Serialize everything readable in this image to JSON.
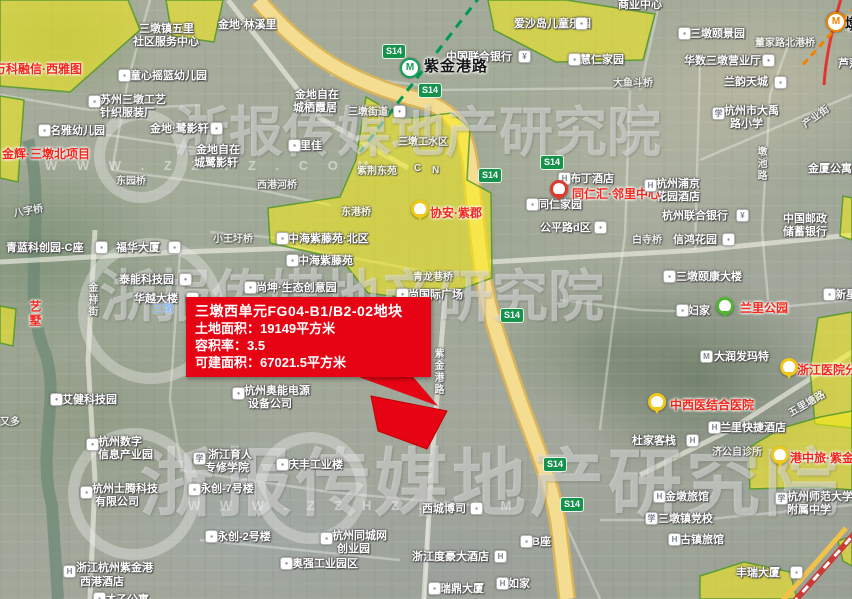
{
  "colors": {
    "accent_red": "#e60313",
    "parcel_fill": "rgba(249,238,20,0.55)",
    "parcel_border": "#55a32b",
    "badge_green": "#15934d",
    "metro_green": "#11a05a",
    "metro_orange": "#f08300",
    "project_red": "#f2261b",
    "water_blue": "#8db4e8"
  },
  "watermark": {
    "brand": "浙报传媒地产研究院",
    "site": "W W W . Z Z H Z . C O M"
  },
  "infobox": {
    "title": "三墩西单元FG04-B1/B2-02地块",
    "land_area": "土地面积：19149平方米",
    "plot_ratio": "容积率：3.5",
    "buildable_area": "可建面积：67021.5平方米"
  },
  "stations": [
    {
      "x": 400,
      "y": 58,
      "c": "#11a05a",
      "g": "M"
    },
    {
      "x": 826,
      "y": 12,
      "c": "#f08300",
      "g": "M"
    }
  ],
  "badges": [
    {
      "x": 382,
      "y": 44,
      "t": "S14"
    },
    {
      "x": 418,
      "y": 83,
      "t": "S14"
    },
    {
      "x": 540,
      "y": 155,
      "t": "S14"
    },
    {
      "x": 478,
      "y": 168,
      "t": "S14"
    },
    {
      "x": 500,
      "y": 308,
      "t": "S14"
    },
    {
      "x": 543,
      "y": 457,
      "t": "S14"
    },
    {
      "x": 560,
      "y": 497,
      "t": "S14"
    }
  ],
  "pins": [
    {
      "x": 550,
      "y": 180,
      "c": "#e0392c"
    },
    {
      "x": 411,
      "y": 200,
      "c": "#eec81b"
    },
    {
      "x": 716,
      "y": 297,
      "c": "#52b335"
    },
    {
      "x": 780,
      "y": 358,
      "c": "#eec81b"
    },
    {
      "x": 648,
      "y": 393,
      "c": "#eec81b"
    },
    {
      "x": 771,
      "y": 446,
      "c": "#eec81b"
    }
  ],
  "red_labels": [
    {
      "t": "万科融信·西雅图",
      "x": -6,
      "y": 60
    },
    {
      "t": "金辉·三墩北项目",
      "x": 2,
      "y": 145
    },
    {
      "t": "同仁汇·邻里中心",
      "x": 572,
      "y": 185
    },
    {
      "t": "协安·紫郡",
      "x": 430,
      "y": 204
    },
    {
      "t": "兰里公园",
      "x": 740,
      "y": 299
    },
    {
      "t": "浙江医院分",
      "x": 797,
      "y": 361
    },
    {
      "t": "中西医结合医院",
      "x": 670,
      "y": 396
    },
    {
      "t": "港中旅·紫金",
      "x": 790,
      "y": 449
    },
    {
      "t": "艺墅",
      "x": 27,
      "y": 300,
      "cls": "v"
    }
  ],
  "poi_labels": [
    {
      "t": "金地·林溪里",
      "x": 218,
      "y": 16
    },
    {
      "t": "三墩镇五里",
      "x": 139,
      "y": 20
    },
    {
      "t": "社区服务中心",
      "x": 133,
      "y": 33
    },
    {
      "t": "童心摇篮幼儿园",
      "x": 130,
      "y": 67
    },
    {
      "t": "苏州三墩工艺",
      "x": 100,
      "y": 91
    },
    {
      "t": "针织服装厂",
      "x": 100,
      "y": 104
    },
    {
      "t": "名雅幼儿园",
      "x": 50,
      "y": 122
    },
    {
      "t": "金地·鹭影轩",
      "x": 150,
      "y": 120
    },
    {
      "t": "金地自在",
      "x": 295,
      "y": 86
    },
    {
      "t": "城栖霞居",
      "x": 293,
      "y": 99
    },
    {
      "t": "里佳",
      "x": 300,
      "y": 137
    },
    {
      "t": "金地自在",
      "x": 196,
      "y": 141
    },
    {
      "t": "城鹭影轩",
      "x": 194,
      "y": 154
    },
    {
      "t": "爱沙岛儿童乐园",
      "x": 514,
      "y": 15
    },
    {
      "t": "中国联合银行",
      "x": 446,
      "y": 48
    },
    {
      "t": "慧仁家园",
      "x": 580,
      "y": 51
    },
    {
      "t": "商业中心",
      "x": 618,
      "y": -4
    },
    {
      "t": "三墩颐景园",
      "x": 690,
      "y": 25
    },
    {
      "t": "董家路北港桥",
      "x": 755,
      "y": 34,
      "cls": "dim"
    },
    {
      "t": "华数三墩营业厅",
      "x": 684,
      "y": 52
    },
    {
      "t": "大鱼斗桥",
      "x": 613,
      "y": 74,
      "cls": "dim"
    },
    {
      "t": "兰韵天城",
      "x": 724,
      "y": 73
    },
    {
      "t": "杭州市大禹",
      "x": 724,
      "y": 102
    },
    {
      "t": "路小学",
      "x": 730,
      "y": 115
    },
    {
      "t": "芦荡",
      "x": 838,
      "y": 55
    },
    {
      "t": "金厦公寓",
      "x": 808,
      "y": 160
    },
    {
      "t": "杭州浦京",
      "x": 656,
      "y": 175
    },
    {
      "t": "花园酒店",
      "x": 656,
      "y": 188
    },
    {
      "t": "布丁酒店",
      "x": 570,
      "y": 170
    },
    {
      "t": "同仁家园",
      "x": 538,
      "y": 196
    },
    {
      "t": "公平路d区",
      "x": 540,
      "y": 219
    },
    {
      "t": "杭州联合银行",
      "x": 662,
      "y": 207
    },
    {
      "t": "白寺桥",
      "x": 632,
      "y": 231,
      "cls": "dim"
    },
    {
      "t": "信鸿花园",
      "x": 673,
      "y": 231
    },
    {
      "t": "中国邮政",
      "x": 783,
      "y": 210
    },
    {
      "t": "储蓄银行",
      "x": 783,
      "y": 223
    },
    {
      "t": "三墩颐康大楼",
      "x": 676,
      "y": 268
    },
    {
      "t": "新星",
      "x": 835,
      "y": 286
    },
    {
      "t": "妇家",
      "x": 688,
      "y": 302
    },
    {
      "t": "大润发玛特",
      "x": 714,
      "y": 348
    },
    {
      "t": "兰里快捷酒店",
      "x": 720,
      "y": 419
    },
    {
      "t": "杜家客栈",
      "x": 632,
      "y": 432
    },
    {
      "t": "济公自诊所",
      "x": 712,
      "y": 443,
      "cls": "dim"
    },
    {
      "t": "杭州师范大学",
      "x": 787,
      "y": 488
    },
    {
      "t": "附属中学",
      "x": 787,
      "y": 501
    },
    {
      "t": "金墩旅馆",
      "x": 665,
      "y": 488
    },
    {
      "t": "三墩镇党校",
      "x": 658,
      "y": 510
    },
    {
      "t": "古镇旅馆",
      "x": 680,
      "y": 531
    },
    {
      "t": "丰瑞大厦",
      "x": 736,
      "y": 564
    },
    {
      "t": "B座",
      "x": 532,
      "y": 533
    },
    {
      "t": "如家",
      "x": 508,
      "y": 575
    },
    {
      "t": "瑞鼎大厦",
      "x": 440,
      "y": 580
    },
    {
      "t": "浙江度豪大酒店",
      "x": 412,
      "y": 548
    },
    {
      "t": "西城博司",
      "x": 422,
      "y": 500
    },
    {
      "t": "杭州同城网",
      "x": 332,
      "y": 527
    },
    {
      "t": "创业园",
      "x": 337,
      "y": 540
    },
    {
      "t": "奥强工业园区",
      "x": 292,
      "y": 555
    },
    {
      "t": "永创-2号楼",
      "x": 217,
      "y": 528
    },
    {
      "t": "永创-7号楼",
      "x": 200,
      "y": 480
    },
    {
      "t": "庆丰工业楼",
      "x": 288,
      "y": 456
    },
    {
      "t": "浙江育人",
      "x": 208,
      "y": 446
    },
    {
      "t": "专修学院",
      "x": 205,
      "y": 459
    },
    {
      "t": "杭州奥能电源",
      "x": 244,
      "y": 382
    },
    {
      "t": "设备公司",
      "x": 248,
      "y": 395
    },
    {
      "t": "艾健科技园",
      "x": 62,
      "y": 391
    },
    {
      "t": "杭州数字",
      "x": 98,
      "y": 433
    },
    {
      "t": "信息产业园",
      "x": 98,
      "y": 446
    },
    {
      "t": "杭州士腾科技",
      "x": 92,
      "y": 480
    },
    {
      "t": "有限公司",
      "x": 95,
      "y": 493
    },
    {
      "t": "又多",
      "x": 0,
      "y": 413,
      "cls": "dim"
    },
    {
      "t": "浙江杭州紫金港",
      "x": 76,
      "y": 559
    },
    {
      "t": "西港酒店",
      "x": 80,
      "y": 573
    },
    {
      "t": "才子公寓",
      "x": 105,
      "y": 591
    },
    {
      "t": "青蓝科创园-C座",
      "x": 6,
      "y": 239
    },
    {
      "t": "福华大厦",
      "x": 116,
      "y": 239
    },
    {
      "t": "小王圩桥",
      "x": 213,
      "y": 230,
      "cls": "dim"
    },
    {
      "t": "中海紫藤苑·北区",
      "x": 288,
      "y": 230
    },
    {
      "t": "中海紫藤苑",
      "x": 298,
      "y": 252
    },
    {
      "t": "泰能科技园",
      "x": 119,
      "y": 271
    },
    {
      "t": "华越大楼",
      "x": 134,
      "y": 290
    },
    {
      "t": "三墩",
      "x": 152,
      "y": 300,
      "cls": "blue"
    },
    {
      "t": "尚坤·生态创意园",
      "x": 256,
      "y": 279
    },
    {
      "t": "青龙巷桥",
      "x": 413,
      "y": 268,
      "cls": "dim"
    },
    {
      "t": "尚国际广场",
      "x": 408,
      "y": 286
    },
    {
      "t": "东港桥",
      "x": 341,
      "y": 203,
      "cls": "dim"
    },
    {
      "t": "紫荆东苑",
      "x": 357,
      "y": 162,
      "cls": "dim"
    },
    {
      "t": "C",
      "x": 414,
      "y": 163,
      "cls": "dim"
    },
    {
      "t": "N",
      "x": 432,
      "y": 165,
      "cls": "dim"
    },
    {
      "t": "三墩街道",
      "x": 348,
      "y": 103,
      "cls": "dim"
    },
    {
      "t": "三墩工水区",
      "x": 398,
      "y": 133,
      "cls": "dim"
    },
    {
      "t": "东园桥",
      "x": 116,
      "y": 172,
      "cls": "dim"
    },
    {
      "t": "西港河桥",
      "x": 257,
      "y": 176,
      "cls": "dim"
    },
    {
      "t": "八字桥",
      "x": 13,
      "y": 202,
      "cls": "dim",
      "rot": -10
    },
    {
      "t": "金祥街",
      "x": 84,
      "y": 282,
      "cls": "dim v"
    },
    {
      "t": "墩池路",
      "x": 753,
      "y": 146,
      "cls": "dim v"
    },
    {
      "t": "紫金港路",
      "x": 430,
      "y": 348,
      "cls": "dim v"
    },
    {
      "t": "产业街",
      "x": 800,
      "y": 108,
      "cls": "dim",
      "rot": -36
    },
    {
      "t": "五里塘路",
      "x": 786,
      "y": 395,
      "cls": "dim",
      "rot": -30
    },
    {
      "t": "紫金港路",
      "x": 424,
      "y": 55,
      "cls": "big"
    },
    {
      "t": "墩",
      "x": 845,
      "y": 13,
      "cls": "big"
    }
  ],
  "icons": [
    {
      "x": 118,
      "y": 69,
      "g": "b"
    },
    {
      "x": 88,
      "y": 95,
      "g": "b"
    },
    {
      "x": 38,
      "y": 124,
      "g": "b"
    },
    {
      "x": 210,
      "y": 122,
      "g": "b"
    },
    {
      "x": 288,
      "y": 139,
      "g": "b"
    },
    {
      "x": 575,
      "y": 17,
      "g": "b"
    },
    {
      "x": 518,
      "y": 50,
      "g": "bank"
    },
    {
      "x": 568,
      "y": 53,
      "g": "b"
    },
    {
      "x": 678,
      "y": 27,
      "g": "b"
    },
    {
      "x": 762,
      "y": 54,
      "g": "dot"
    },
    {
      "x": 774,
      "y": 76,
      "g": "b"
    },
    {
      "x": 712,
      "y": 107,
      "g": "s"
    },
    {
      "x": 644,
      "y": 179,
      "g": "h"
    },
    {
      "x": 558,
      "y": 172,
      "g": "h"
    },
    {
      "x": 526,
      "y": 198,
      "g": "b"
    },
    {
      "x": 594,
      "y": 221,
      "g": "b"
    },
    {
      "x": 736,
      "y": 209,
      "g": "bank"
    },
    {
      "x": 722,
      "y": 233,
      "g": "b"
    },
    {
      "x": 663,
      "y": 270,
      "g": "b"
    },
    {
      "x": 823,
      "y": 288,
      "g": "b"
    },
    {
      "x": 676,
      "y": 304,
      "g": "b"
    },
    {
      "x": 700,
      "y": 350,
      "g": "m"
    },
    {
      "x": 708,
      "y": 421,
      "g": "h"
    },
    {
      "x": 686,
      "y": 434,
      "g": "h"
    },
    {
      "x": 775,
      "y": 492,
      "g": "s"
    },
    {
      "x": 790,
      "y": 566,
      "g": "b"
    },
    {
      "x": 653,
      "y": 490,
      "g": "h"
    },
    {
      "x": 645,
      "y": 512,
      "g": "s"
    },
    {
      "x": 668,
      "y": 533,
      "g": "h"
    },
    {
      "x": 520,
      "y": 535,
      "g": "b"
    },
    {
      "x": 496,
      "y": 577,
      "g": "h"
    },
    {
      "x": 428,
      "y": 582,
      "g": "b"
    },
    {
      "x": 494,
      "y": 550,
      "g": "h"
    },
    {
      "x": 470,
      "y": 502,
      "g": "b"
    },
    {
      "x": 320,
      "y": 532,
      "g": "b"
    },
    {
      "x": 280,
      "y": 557,
      "g": "dot"
    },
    {
      "x": 205,
      "y": 530,
      "g": "b"
    },
    {
      "x": 188,
      "y": 483,
      "g": "b"
    },
    {
      "x": 276,
      "y": 458,
      "g": "b"
    },
    {
      "x": 193,
      "y": 452,
      "g": "s"
    },
    {
      "x": 232,
      "y": 387,
      "g": "dot"
    },
    {
      "x": 50,
      "y": 393,
      "g": "dot"
    },
    {
      "x": 86,
      "y": 438,
      "g": "dot"
    },
    {
      "x": 80,
      "y": 486,
      "g": "b"
    },
    {
      "x": 63,
      "y": 565,
      "g": "h"
    },
    {
      "x": 93,
      "y": 592,
      "g": "b"
    },
    {
      "x": 95,
      "y": 241,
      "g": "b"
    },
    {
      "x": 168,
      "y": 241,
      "g": "b"
    },
    {
      "x": 179,
      "y": 273,
      "g": "dot"
    },
    {
      "x": 186,
      "y": 292,
      "g": "b"
    },
    {
      "x": 244,
      "y": 281,
      "g": "b"
    },
    {
      "x": 396,
      "y": 288,
      "g": "dot"
    },
    {
      "x": 276,
      "y": 232,
      "g": "b"
    },
    {
      "x": 286,
      "y": 254,
      "g": "b"
    },
    {
      "x": 393,
      "y": 105,
      "g": "dot"
    }
  ]
}
